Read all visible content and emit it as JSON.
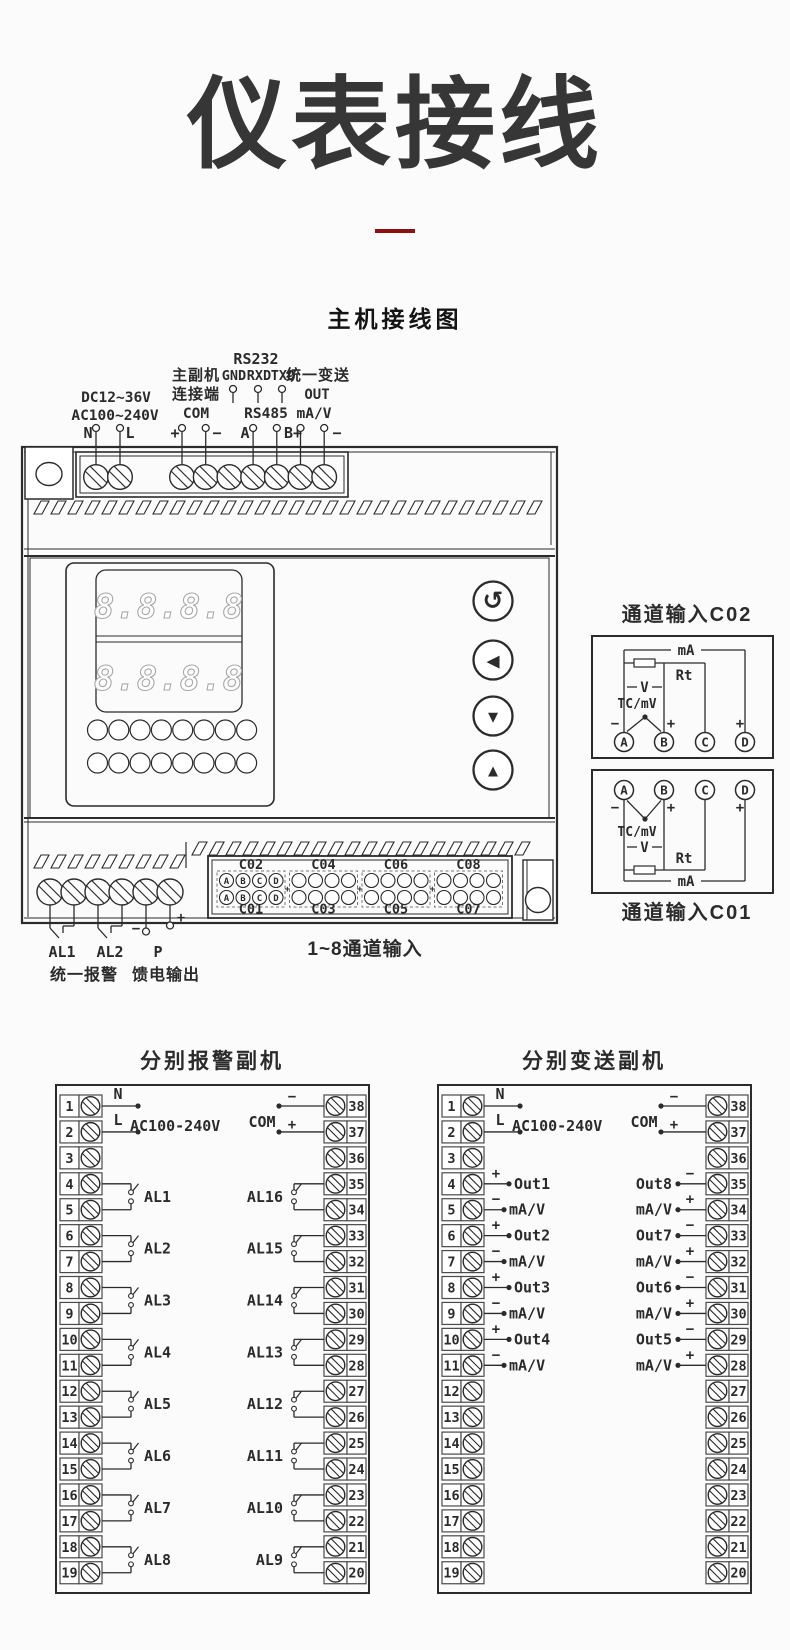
{
  "page": {
    "title": "仪表接线",
    "subtitle": "主机接线图",
    "divider_color": "#8e1111",
    "ink": "#2b2b2b"
  },
  "main_unit": {
    "power_labels": {
      "dc": "DC12~36V",
      "ac": "AC100~240V"
    },
    "rs232": {
      "title": "RS232",
      "pins": [
        "GND",
        "RXD",
        "TXD"
      ]
    },
    "master_slave": {
      "line1": "主副机",
      "line2": "连接端"
    },
    "unified_transmit": {
      "line1": "统一变送",
      "line2": "OUT"
    },
    "com": "COM",
    "rs485": "RS485",
    "mav": "mA/V",
    "terminal_wire_labels": [
      "N",
      "L",
      "+",
      "−",
      "A",
      "B+",
      "−"
    ],
    "display_rows": [
      "8.8.8.8",
      "8.8.8.8"
    ],
    "buttons": [
      {
        "name": "cycle",
        "icon": "↺"
      },
      {
        "name": "left",
        "icon": "◀"
      },
      {
        "name": "down",
        "icon": "▼"
      },
      {
        "name": "up",
        "icon": "▲"
      }
    ],
    "bottom": {
      "al1": "AL1",
      "al2": "AL2",
      "p": "P",
      "minus": "−",
      "plus": "+",
      "unified_alarm": "统一报警",
      "feed_output": "馈电输出",
      "channels": "1~8通道输入"
    },
    "connector": {
      "top": [
        "C02",
        "C04",
        "C06",
        "C08"
      ],
      "bottom": [
        "C01",
        "C03",
        "C05",
        "C07"
      ],
      "pins": [
        "A",
        "B",
        "C",
        "D"
      ],
      "plus": "+"
    }
  },
  "channel_inputs": [
    {
      "title": "通道输入C02",
      "orientation": "down",
      "terminals": [
        "A",
        "B",
        "C",
        "D"
      ],
      "labels": {
        "ma": "mA",
        "rt": "Rt",
        "v": "V",
        "tc": "TC/mV",
        "plus": "+",
        "minus": "−"
      }
    },
    {
      "title": "通道输入C01",
      "orientation": "up",
      "terminals": [
        "A",
        "B",
        "C",
        "D"
      ],
      "labels": {
        "ma": "mA",
        "rt": "Rt",
        "v": "V",
        "tc": "TC/mV",
        "plus": "+",
        "minus": "−"
      }
    }
  ],
  "alarm_slave": {
    "title": "分别报警副机",
    "power": {
      "n": "N",
      "l": "L",
      "voltage": "AC100-240V"
    },
    "com": {
      "label": "COM",
      "minus": "−",
      "plus": "+"
    },
    "left_terminals": [
      1,
      2,
      3,
      4,
      5,
      6,
      7,
      8,
      9,
      10,
      11,
      12,
      13,
      14,
      15,
      16,
      17,
      18,
      19
    ],
    "right_terminals": [
      38,
      37,
      36,
      35,
      34,
      33,
      32,
      31,
      30,
      29,
      28,
      27,
      26,
      25,
      24,
      23,
      22,
      21,
      20
    ],
    "left_relays": [
      "AL1",
      "AL2",
      "AL3",
      "AL4",
      "AL5",
      "AL6",
      "AL7",
      "AL8"
    ],
    "right_relays": [
      "AL16",
      "AL15",
      "AL14",
      "AL13",
      "AL12",
      "AL11",
      "AL10",
      "AL9"
    ]
  },
  "transmit_slave": {
    "title": "分别变送副机",
    "power": {
      "n": "N",
      "l": "L",
      "voltage": "AC100-240V"
    },
    "com": {
      "label": "COM",
      "minus": "−",
      "plus": "+"
    },
    "left_terminals": [
      1,
      2,
      3,
      4,
      5,
      6,
      7,
      8,
      9,
      10,
      11,
      12,
      13,
      14,
      15,
      16,
      17,
      18,
      19
    ],
    "right_terminals": [
      38,
      37,
      36,
      35,
      34,
      33,
      32,
      31,
      30,
      29,
      28,
      27,
      26,
      25,
      24,
      23,
      22,
      21,
      20
    ],
    "left_outputs": [
      {
        "label": "Out1",
        "unit": "mA/V",
        "plus": "+",
        "minus": "−"
      },
      {
        "label": "Out2",
        "unit": "mA/V",
        "plus": "+",
        "minus": "−"
      },
      {
        "label": "Out3",
        "unit": "mA/V",
        "plus": "+",
        "minus": "−"
      },
      {
        "label": "Out4",
        "unit": "mA/V",
        "plus": "+",
        "minus": "−"
      }
    ],
    "right_outputs": [
      {
        "label": "Out8",
        "unit": "mA/V",
        "plus": "+",
        "minus": "−"
      },
      {
        "label": "Out7",
        "unit": "mA/V",
        "plus": "+",
        "minus": "−"
      },
      {
        "label": "Out6",
        "unit": "mA/V",
        "plus": "+",
        "minus": "−"
      },
      {
        "label": "Out5",
        "unit": "mA/V",
        "plus": "+",
        "minus": "−"
      }
    ]
  }
}
